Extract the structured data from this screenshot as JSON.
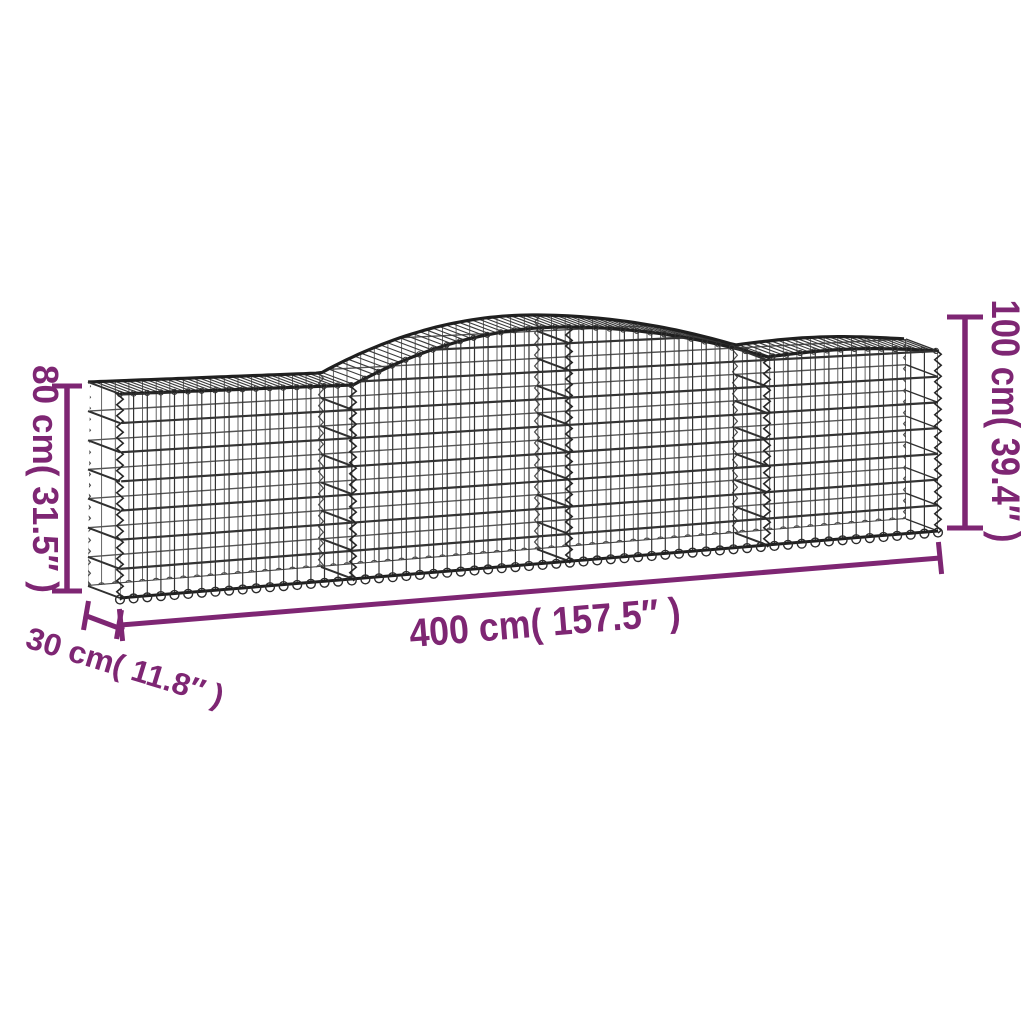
{
  "diagram": {
    "type": "product-dimension-diagram",
    "subject": "arched-gabion-wire-mesh-basket",
    "dimensions": {
      "height_left": {
        "label": "80 cm( 31.5″ )"
      },
      "height_right": {
        "label": "100 cm( 39.4″ )"
      },
      "length": {
        "label": "400 cm( 157.5″ )"
      },
      "depth": {
        "label": "30 cm( 11.8″ )"
      }
    },
    "colors": {
      "annotation": "#7e2673",
      "wire": "#3a3a3a",
      "wire_dark": "#1f1f1f",
      "wire_back": "#555555",
      "background": "#ffffff"
    }
  }
}
